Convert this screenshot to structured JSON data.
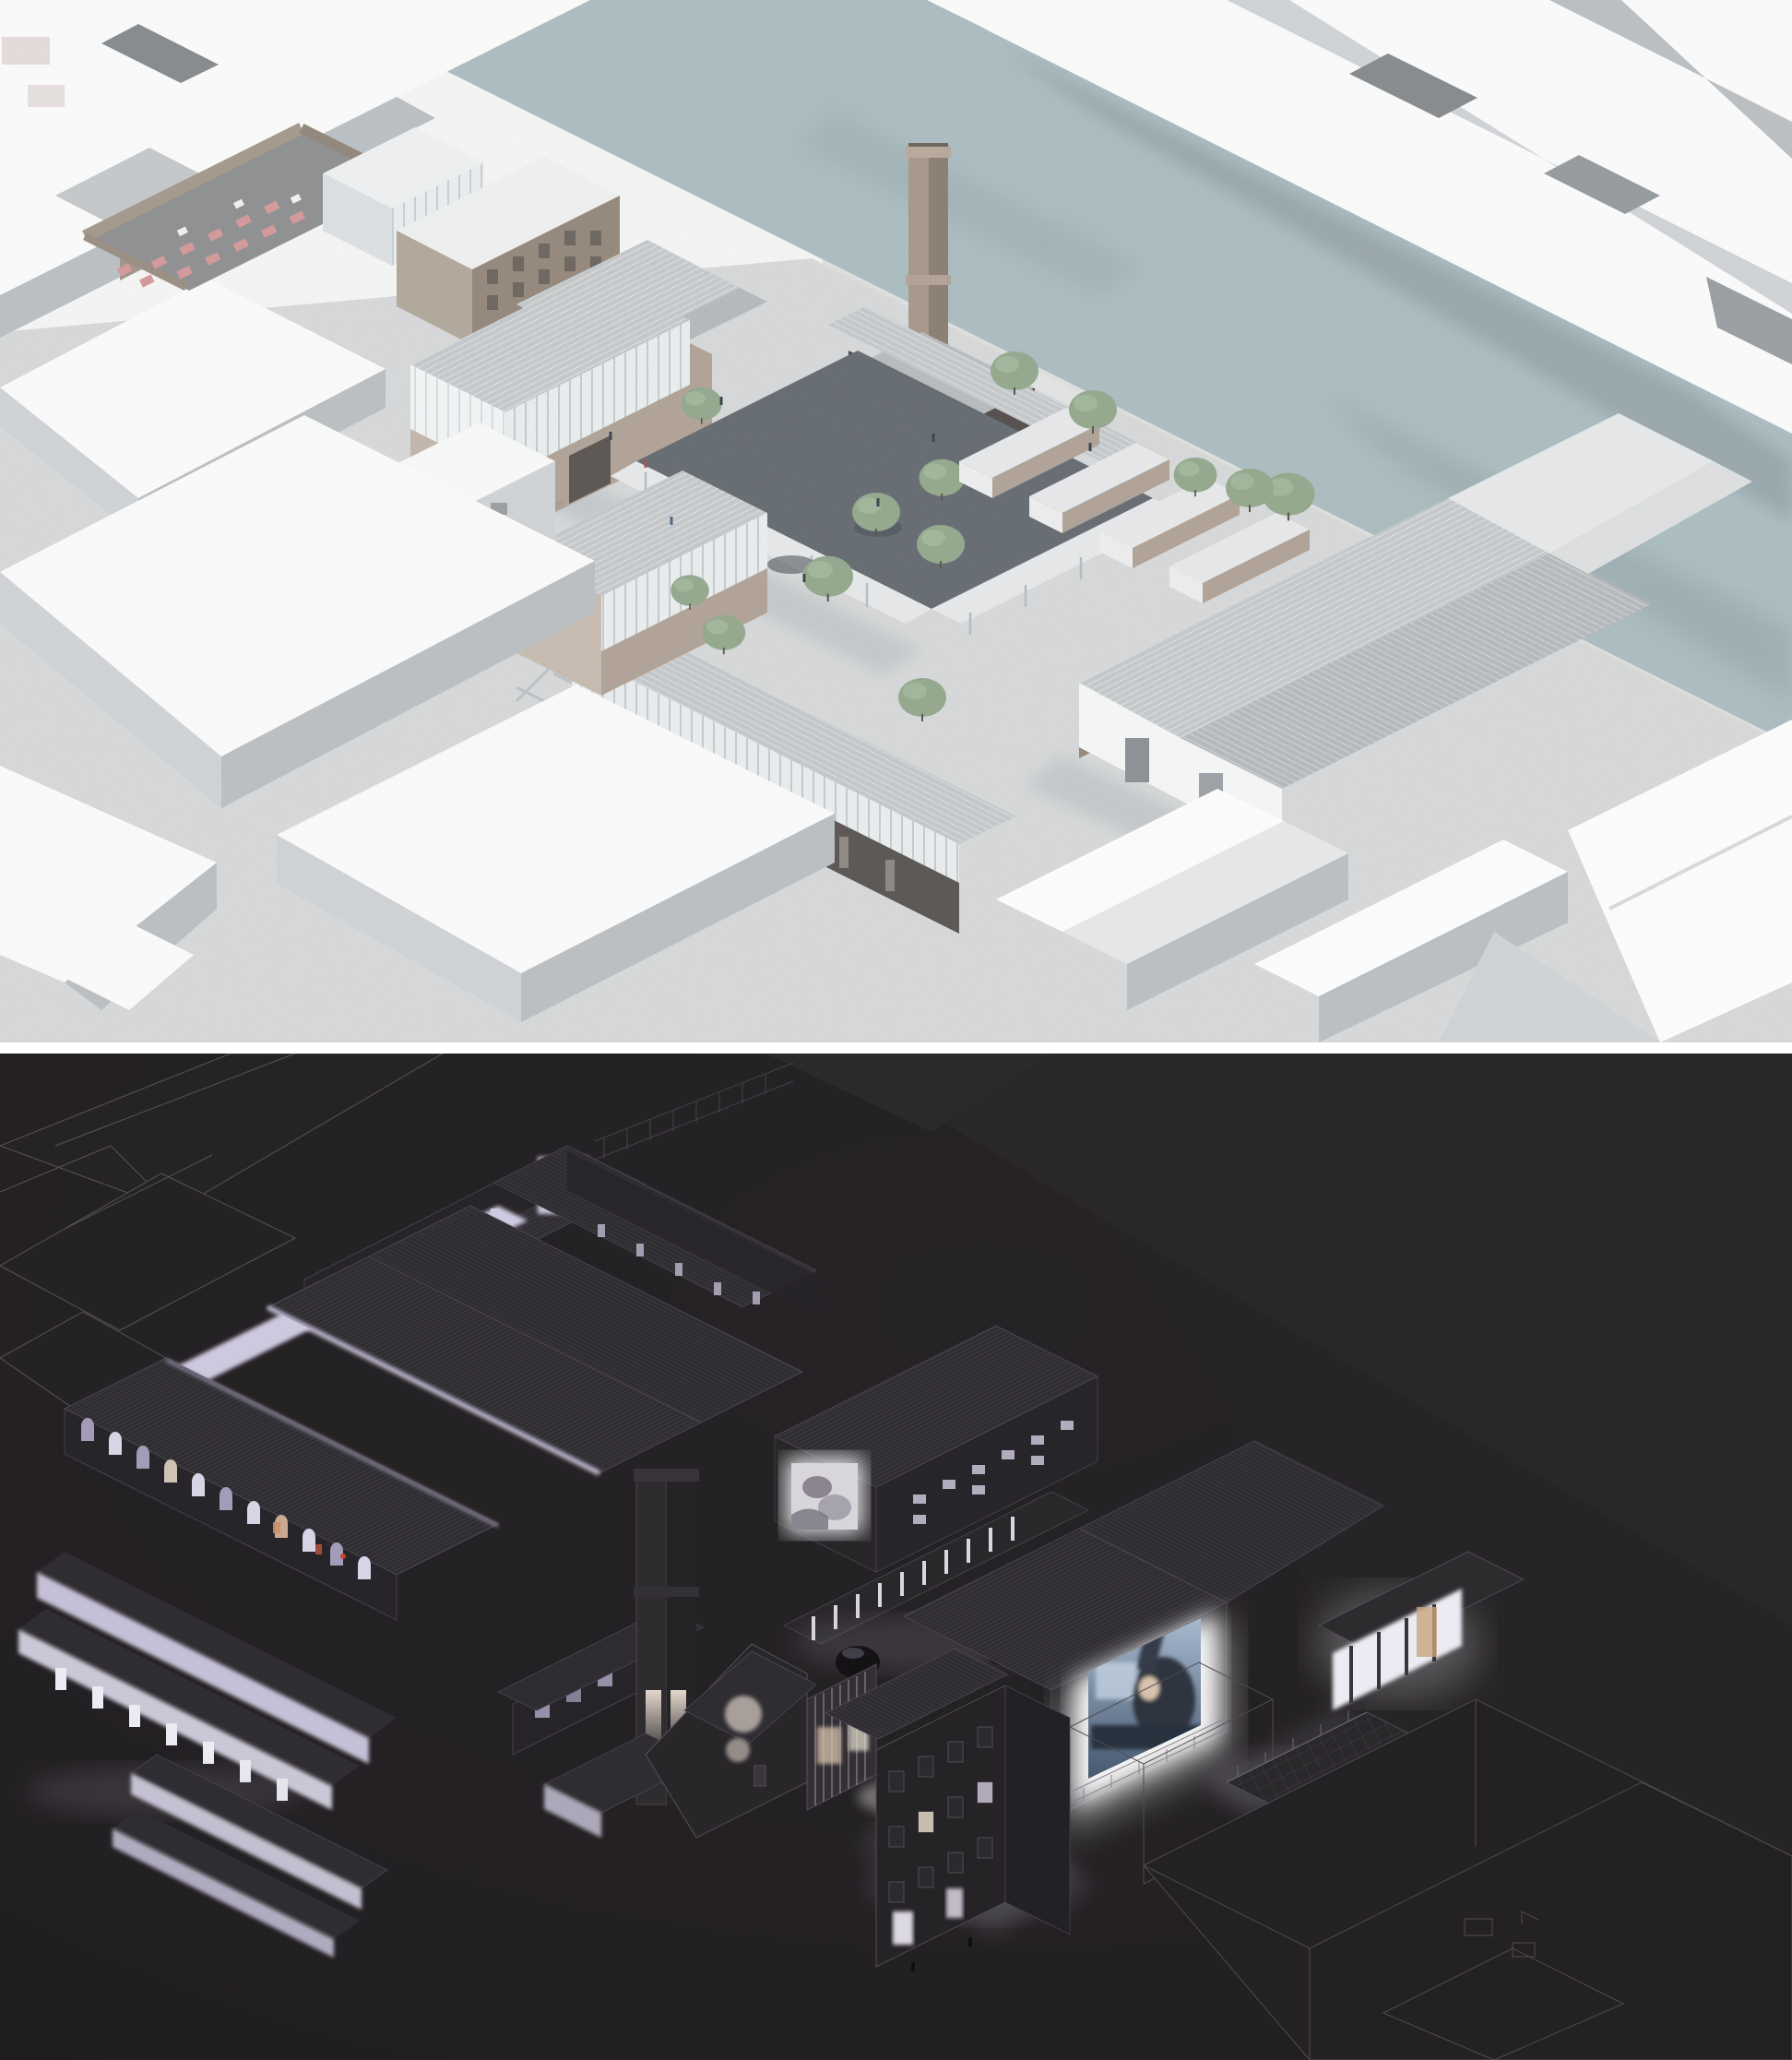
{
  "document": {
    "kind": "architectural-visualization-board",
    "layout": "two stacked isometric/axonometric renders of the same riverside factory campus, separated by a thin white divider",
    "visible_text": "none"
  },
  "day_view": {
    "label": "daytime aerial axonometric masterplan render",
    "features": [
      "pale blue river running diagonally with shadow cast from far-bank buildings",
      "white abstract context massing on both banks",
      "brick factory complex with tall brick chimney",
      "glass atrium with arched colonnade upper storey",
      "rooftop terrace with pink cafe seating",
      "tree-filled courtyard wrapped by white canopy colonnade",
      "row of saw-tooth sheds with brick walls",
      "riverside promenade with line of trees",
      "large gray-roofed warehouse with glass clerestory",
      "tiny pedestrian figures"
    ]
  },
  "night_view": {
    "label": "nighttime axonometric render of the same campus",
    "features": [
      "near-black background with faint wireframe context buildings",
      "warehouse with glowing lavender clerestories and lit arcade",
      "rows of glowing saw-tooth shed clerestories",
      "dark brick chimney with two lit niches",
      "small projection on a gable wall",
      "large outdoor cinema screen showing a bluish film still with a figure",
      "glowing colonnade pavilion casting light beams",
      "three-storey house with scattered lit windows",
      "gridded terrace deck and tiny wireframe cars"
    ]
  },
  "colors": {
    "day": {
      "paper": "#f6f7f6",
      "river": "#afc3c8",
      "rivershadow": "#8b989c",
      "quay": "#dfe1e2",
      "massingtop": "#fdfdfd",
      "massingface": "#bcc1c5",
      "massingfacelight": "#d2d5d8",
      "notch": "#878c90",
      "ground": "#d8dadb",
      "shadow": "#7b838a",
      "roof": "#c7cacc",
      "roofdark": "#b7bbbe",
      "roofwhite": "#e9eaeb",
      "brick": "#b2a498",
      "brickdark": "#96897d",
      "brickdeep": "#5c5754",
      "darkwall": "#4c4847",
      "glass": "#ebeff0",
      "mullion": "#b9bec2",
      "canopy": "#e8eaeb",
      "courtyard": "#666d73",
      "tree": "#94aa8e",
      "treelight": "#a8bca2",
      "pink": "#d59a9a",
      "people": "#3c4550"
    },
    "night": {
      "bg": "#232023",
      "bgdeep": "#1e1c1e",
      "silhouette": "#2a272a",
      "silhouette2": "#272427",
      "wire": "#575458",
      "wiredim": "#454247",
      "building": "#28252a",
      "roof": "#302d32",
      "hatch": "#3d3a41",
      "glowwhite": "#eceaf2",
      "glowlav": "#cfc9e0",
      "glowwarm": "#d8c3ab",
      "arch": "#a39cb8",
      "screenlight": "#9db1c9",
      "screendark": "#46586f",
      "face": "#d6c3ad",
      "beam": "#dcd8ea",
      "pool": "#b4aec8"
    }
  }
}
